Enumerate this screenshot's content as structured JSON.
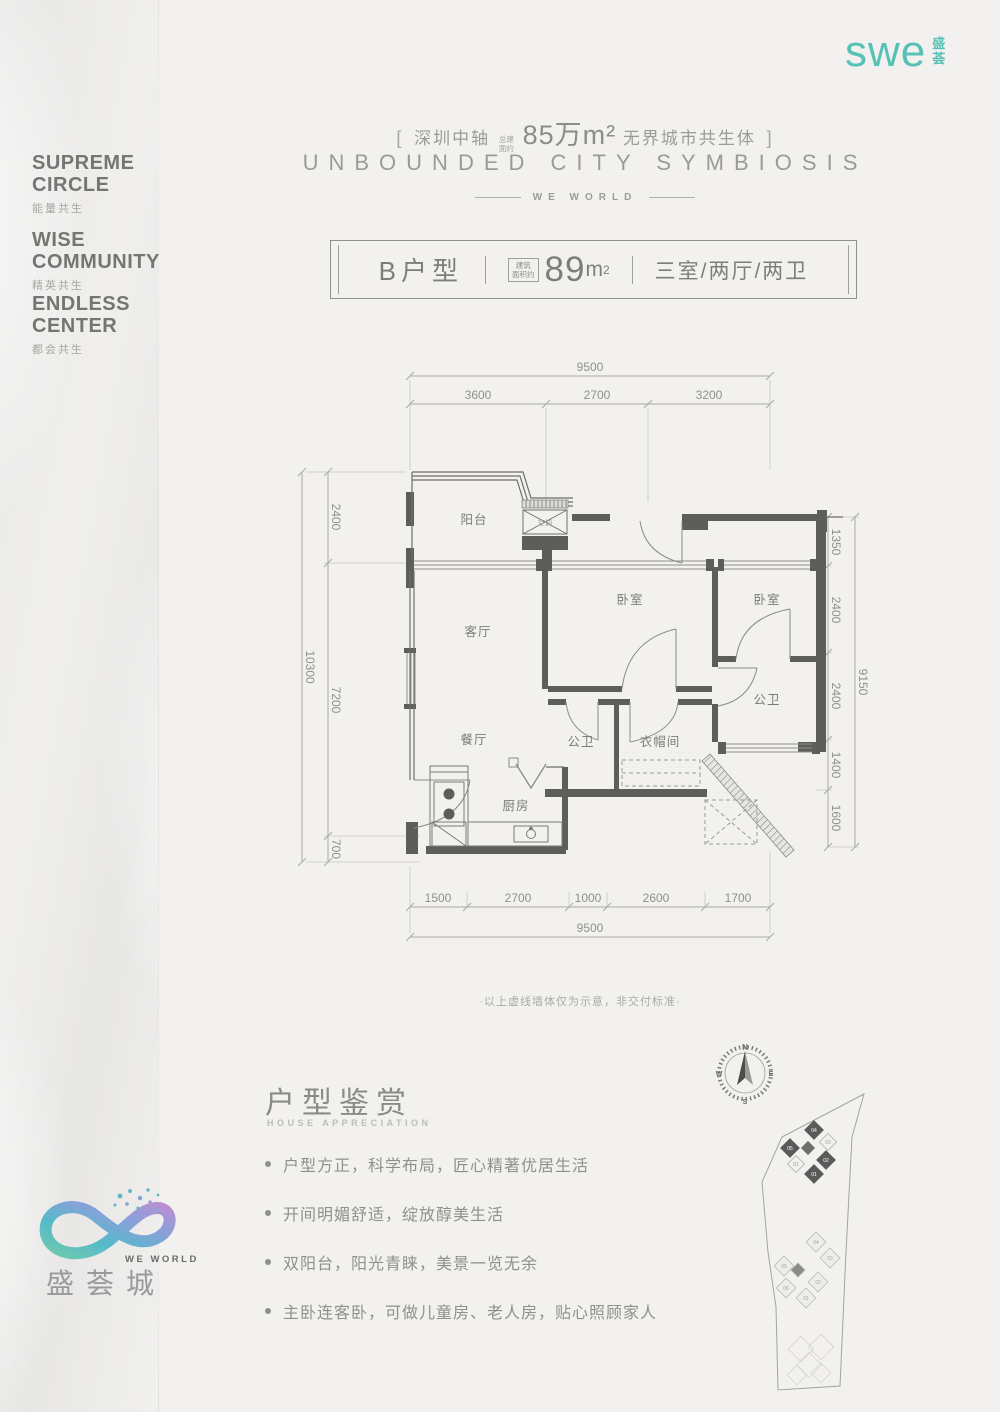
{
  "brand": {
    "logo": "swe",
    "logo_cn_1": "盛",
    "logo_cn_2": "荟"
  },
  "header": {
    "bracket_left": "[",
    "bracket_right": "]",
    "tagline_prefix": "深圳中轴",
    "area_tag_line1": "总建",
    "area_tag_line2": "面约",
    "area_highlight": "85万m²",
    "tagline_suffix": "无界城市共生体",
    "title_en": "UNBOUNDED CITY SYMBIOSIS",
    "subtitle_en": "WE WORLD"
  },
  "side_labels": [
    {
      "en_line1": "SUPREME",
      "en_line2": "CIRCLE",
      "cn": "能量共生"
    },
    {
      "en_line1": "WISE",
      "en_line2": "COMMUNITY",
      "cn": "精英共生"
    },
    {
      "en_line1": "ENDLESS",
      "en_line2": "CENTER",
      "cn": "都会共生"
    }
  ],
  "unit_bar": {
    "name": "B户型",
    "area_tag_line1": "建筑",
    "area_tag_line2": "面积约",
    "area_number": "89",
    "area_unit": "m",
    "area_sup": "2",
    "rooms": "三室/两厅/两卫"
  },
  "floorplan": {
    "rooms": {
      "balcony": "阳台",
      "living": "客厅",
      "dining": "餐厅",
      "kitchen": "厨房",
      "bedroom1": "卧室",
      "bedroom2": "卧室",
      "bath_right": "公卫",
      "bath_center": "公卫",
      "cloakroom": "衣帽间",
      "ac": "空调"
    },
    "dims": {
      "top_total": "9500",
      "top": [
        "3600",
        "2700",
        "3200"
      ],
      "left_total": "10300",
      "left": [
        "2400",
        "7200",
        "700"
      ],
      "right_total": "9150",
      "right": [
        "1350",
        "2400",
        "2400",
        "1400",
        "1600"
      ],
      "bottom_total": "9500",
      "bottom": [
        "1500",
        "2700",
        "1000",
        "2600",
        "1700"
      ]
    },
    "note": "·以上虚线墙体仅为示意，非交付标准·"
  },
  "appreciation": {
    "title_cn": "户型鉴赏",
    "title_en": "HOUSE APPRECIATION",
    "bullets": [
      "户型方正，科学布局，匠心精著优居生活",
      "开间明媚舒适，绽放醇美生活",
      "双阳台，阳光青睐，美景一览无余",
      "主卧连客卧，可做儿童房、老人房，贴心照顾家人"
    ]
  },
  "compass": {
    "n": "N",
    "e": "E",
    "s": "S",
    "w": "W"
  },
  "siteplan": {
    "dark_labels": [
      "04",
      "05",
      "02",
      "01"
    ],
    "light_labels": [
      "03",
      "01"
    ],
    "mid_labels": [
      "04",
      "03",
      "05",
      "06",
      "02",
      "01"
    ]
  },
  "footer": {
    "logo_en": "WE WORLD",
    "logo_cn": "盛荟城"
  }
}
